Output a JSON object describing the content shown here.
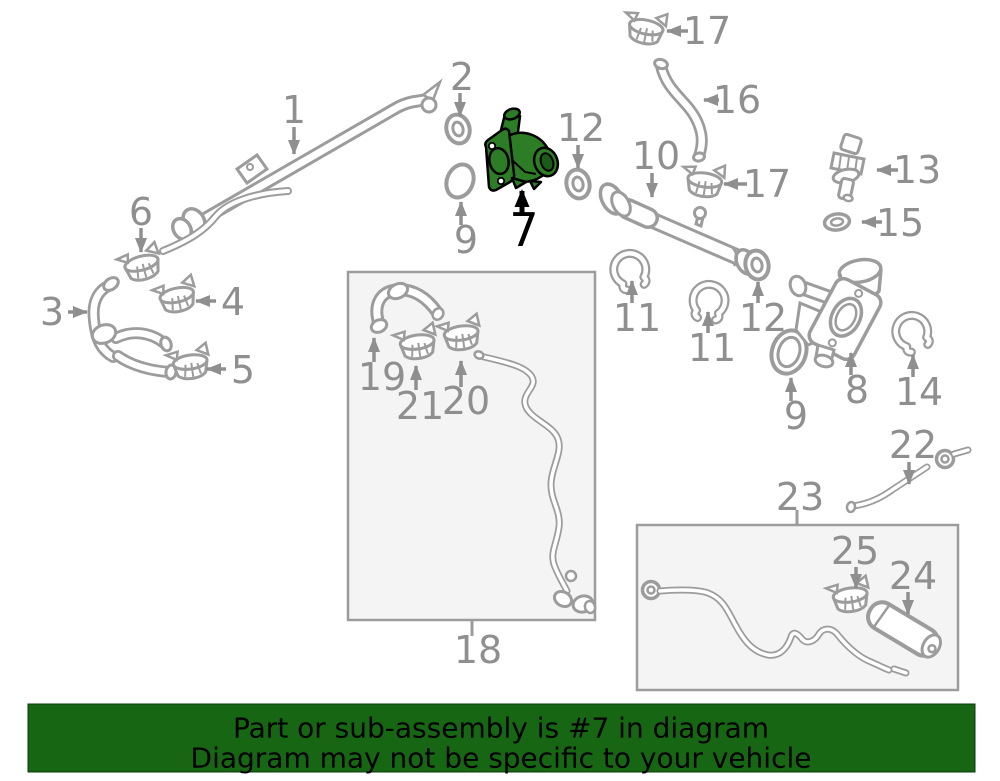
{
  "diagram": {
    "highlighted_part": "7",
    "callouts": [
      {
        "label": "1"
      },
      {
        "label": "2"
      },
      {
        "label": "3"
      },
      {
        "label": "4"
      },
      {
        "label": "5"
      },
      {
        "label": "6"
      },
      {
        "label": "7",
        "highlighted": true
      },
      {
        "label": "8"
      },
      {
        "label": "9"
      },
      {
        "label": "9"
      },
      {
        "label": "10"
      },
      {
        "label": "11"
      },
      {
        "label": "11"
      },
      {
        "label": "12"
      },
      {
        "label": "12"
      },
      {
        "label": "13"
      },
      {
        "label": "14"
      },
      {
        "label": "15"
      },
      {
        "label": "16"
      },
      {
        "label": "17"
      },
      {
        "label": "17"
      },
      {
        "label": "18"
      },
      {
        "label": "19"
      },
      {
        "label": "20"
      },
      {
        "label": "21"
      },
      {
        "label": "22"
      },
      {
        "label": "23"
      },
      {
        "label": "24"
      },
      {
        "label": "25"
      }
    ],
    "colors": {
      "line": "#9c9c9c",
      "label": "#8f8f8f",
      "highlight": "#2d7d26",
      "highlight_outline": "#000000",
      "box_fill": "#f4f4f4",
      "banner_bg": "#166613",
      "banner_text": "#000000",
      "background": "#ffffff"
    }
  },
  "banner": {
    "line1": "Part or sub-assembly is #7 in diagram",
    "line2": "Diagram may not be specific to your vehicle"
  }
}
